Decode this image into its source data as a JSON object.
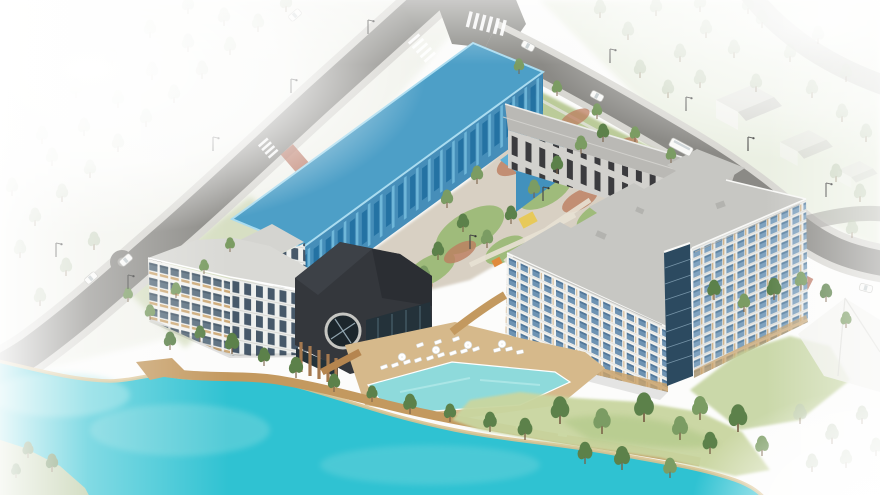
{
  "meta": {
    "title": "Aerial architectural rendering of a waterfront mixed-use residential development with one building massing highlighted in blue",
    "image_type": "3D isometric site massing render",
    "width_px": 880,
    "height_px": 495
  },
  "scene": {
    "highlighted_building": {
      "label": "highlighted bar building",
      "description": "Long rectangular building volume along the upper street shaded in translucent blue to mark the subject parcel",
      "highlight_color": "#4d9fc7",
      "visible_stories": 4
    },
    "buildings": [
      {
        "label": "townhouse row",
        "description": "Low gray row building with dark vertical window slots fronting the upper-right street"
      },
      {
        "label": "l-shaped tower",
        "description": "Large 8-story L-shaped apartment block, white grid facade with blue glazing and a corner glass stair tower"
      },
      {
        "label": "mid-rise block",
        "description": "5-story white residential block with ribbon windows and wood spandrels near the waterfront"
      },
      {
        "label": "amenity clubhouse",
        "description": "Dark charcoal amenity pavilion with a large circular window and wood-slat glazed base"
      },
      {
        "label": "neighboring houses",
        "description": "Faded white gabled houses and a tent-like structure at the image edges"
      }
    ],
    "site_features": [
      {
        "label": "lake",
        "description": "Turquoise lake wrapping the lower-left of the site"
      },
      {
        "label": "swimming pool",
        "description": "Resort-style pool on a tan deck between the clubhouse and the tower"
      },
      {
        "label": "pool deck",
        "lounge_chairs": 15,
        "umbrellas": 4
      },
      {
        "label": "waterfront promenade",
        "description": "Wooden boardwalk following the shoreline with street trees"
      },
      {
        "label": "central courtyard",
        "description": "Landscaped courtyard with winding paths, lawn, red mulch planting, a yellow play structure and an orange shade canopy"
      },
      {
        "label": "streets",
        "description": "Perimeter roads with sidewalks, zebra crosswalks, brick crossings, street lamps and a small roundabout"
      }
    ],
    "vehicles": {
      "white_cars": 5,
      "gray_cars": 1,
      "bus": 1
    },
    "trees": {
      "crisp_site_trees": "dark green pines around courtyard, pool and shoreline",
      "faded_context_trees": "pale washed-out trees around the image edges"
    },
    "effects": {
      "edge_treatment": "white vignette fading toward all edges, strongest at top-left and corners"
    }
  },
  "palette": {
    "lake": "#2fc2d2",
    "lakeEdge": "#7fd8de",
    "sand": "#dcc28f",
    "pool": "#8edadb",
    "asphalt": "#8b8a86",
    "sidewalk": "#d8d7d2",
    "roofGray": "#c7c7c3",
    "roofMid": "#d9d9d5",
    "wall": "#f3f3f0",
    "winBlue": "#6e93b3",
    "winShade": "#51779a",
    "woodTan": "#c9a26b",
    "townWall": "#d2d1cd",
    "townSlot": "#3b3b3e",
    "townRoof": "#bab9b5",
    "blueRoof": "#4d9fc7",
    "blueEdge": "#aadcf0",
    "blueFace": "#3c88b5",
    "blueWinD": "#1e6d9f",
    "blueWinL": "#7cc4e4",
    "dark": "#34373c",
    "darkLight": "#3d4147",
    "darkGlass": "#24323a",
    "pier": "#a5794f",
    "towerGlass": "#2c4a60",
    "grass": "#9cba78",
    "grassSoft": "#c9d6a0",
    "grassFade": "#e9eedf",
    "mulch": "#bd7e60",
    "path": "#d8d0c3",
    "deck": "#d6b98b",
    "board": "#c3995f",
    "treeDark": "#5c814a",
    "treeMid": "#7b9c63",
    "treeFade": "#bac8af",
    "trunk": "#7a6248",
    "crossRed": "#b0604a",
    "playYellow": "#e7c95a",
    "accentOrange": "#e08a3c",
    "carBody": "#fafaf8",
    "lampPole": "#4a4a48"
  }
}
